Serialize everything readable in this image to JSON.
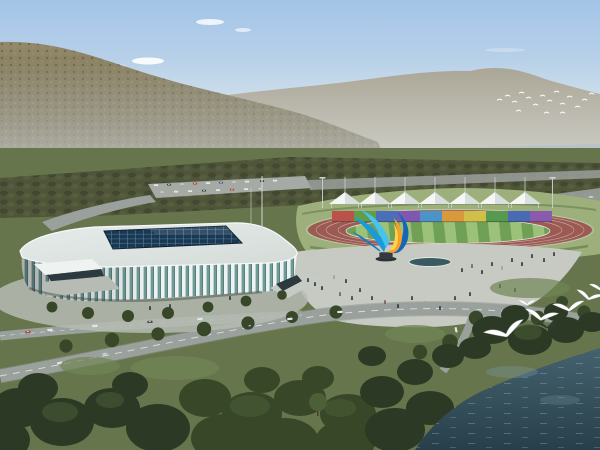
{
  "scene": {
    "type": "architectural-aerial-rendering",
    "description": "Aerial rendering of a riverside sports complex: a white ribbed indoor arena with a dark glass skylight roof, an outdoor athletics track with a rainbow grandstand wall under a row of white canopy tents, a colorful ribbon sculpture on a paved plaza with pedestrians, tree-lined roads with cars, forested mountains and a pale river behind, a flock of distant birds, and large white seagulls flying over dark shoreline trees beside a deep teal lake in the foreground.",
    "objects": [
      {
        "id": "forest-mountain",
        "label": "forested mountain slope"
      },
      {
        "id": "far-ridge",
        "label": "hazy distant mountain ridge"
      },
      {
        "id": "river",
        "label": "pale distant river"
      },
      {
        "id": "arena",
        "label": "indoor arena with white ribbed facade and glass skylight"
      },
      {
        "id": "athletics-track",
        "label": "running track with striped green infield"
      },
      {
        "id": "grandstand-panels",
        "label": "rainbow grandstand panel wall"
      },
      {
        "id": "canopy-tents",
        "label": "row of white peaked canopy tents"
      },
      {
        "id": "sculpture",
        "label": "blue and orange ribbon sculpture"
      },
      {
        "id": "plaza",
        "label": "paved plaza with pedestrians and pool"
      },
      {
        "id": "lake",
        "label": "dark teal lake"
      },
      {
        "id": "seagulls",
        "label": "white seagulls over shoreline trees"
      }
    ],
    "counts": {
      "tents": 7,
      "grandstand_panels": 10,
      "seagulls": 7,
      "distant_birds": 17
    }
  },
  "colors": {
    "sky_top": "#a3c4e8",
    "sky_mid": "#cfdfe9",
    "sky_horizon": "#eaeeee",
    "cloud": "#ffffff",
    "haze": "#e9eef0",
    "far_ridge": "#a8a392",
    "mountain_top": "#93896a",
    "mountain_base": "#5f5b45",
    "mountain_texture_dark": "#4b4937",
    "mountain_texture_light": "#a39a76",
    "river": "#b7c3c7",
    "land": "#66754c",
    "tree_belt": "#4f5539",
    "tree_clump_dark": "#3e432e",
    "tree_clump_light": "#5d6443",
    "parking": "#a6aaa4",
    "road": "#9aa09c",
    "road_edge": "#8b918d",
    "road_dash": "#e8ebe8",
    "apron": "#9db07c",
    "hedge": "#6c8454",
    "track": "#9c5a52",
    "track_lane_line": "#cbbab6",
    "track_rail": "#e0d8d4",
    "field_light": "#9cc27a",
    "field_dark": "#6fa055",
    "field_edge": "#e8e4de",
    "panels": [
      "#b8524a",
      "#5f9e4a",
      "#4a6fb8",
      "#7e57b0",
      "#4a94c8",
      "#d89a3a",
      "#cfc04a",
      "#569a50",
      "#4a6ab4",
      "#8a5aac"
    ],
    "panel_shade": "#1a1a1a",
    "tent_white": "#f5f7f6",
    "tent_shade": "#d9dfde",
    "tent_mast": "#c8cecb",
    "floodlight": "#cdd3d1",
    "sculpture_cyan_light": "#46c4ec",
    "sculpture_cyan": "#1a9ad6",
    "sculpture_cyan_deep": "#0e7cc0",
    "sculpture_blue": "#1565b8",
    "sculpture_orange": "#f59f2c",
    "sculpture_yellow": "#ffd44a",
    "sculpture_base": "#343b40",
    "sculpture_plinth": "#2c3136",
    "roof": "#e7ecea",
    "roof_shade": "#d3dbd7",
    "roof_rim": "#f6f9f8",
    "skylight": "#1c3750",
    "skylight_grid": "#4d7fa0",
    "skylight_gloss": "#ffffff",
    "facade_glass": "#6f9c98",
    "facade_rib": "#eef2f1",
    "facade_dark": "#35514d",
    "entrance_dark": "#2c3a40",
    "walkway": "#b6bcb4",
    "base_shadow": "#3f4a42",
    "plaza": "#c6cac3",
    "pool": "#3a5a62",
    "pool_rim": "#e2e6e2",
    "person_dark": "#2e3338",
    "person_alt": "#7a5a48",
    "person_light": "#9aa0a4",
    "flagpole": "#d4d9d6",
    "foreground_tree": "#2c3a25",
    "foreground_tree_mid": "#374728",
    "foreground_tree_light": "#4c5f37",
    "lawn": "#5f7247",
    "lawn_light": "#708455",
    "trunk": "#4a3d2e",
    "water_top": "#44626e",
    "water_bottom": "#283f4a",
    "water_glint": "#cfe0e4",
    "water_sheen": "#7e98a2",
    "gull_white": "#ffffff",
    "gull_edge": "#9aa59f",
    "gull_dark": "#2f3d33",
    "car_red": "#b03a30",
    "car_white": "#e9ebe9",
    "car_dark": "#3a4248",
    "car_silver": "#b9bfc2",
    "car_blue": "#3c5a8a",
    "car_glass": "#cfe0e8"
  }
}
